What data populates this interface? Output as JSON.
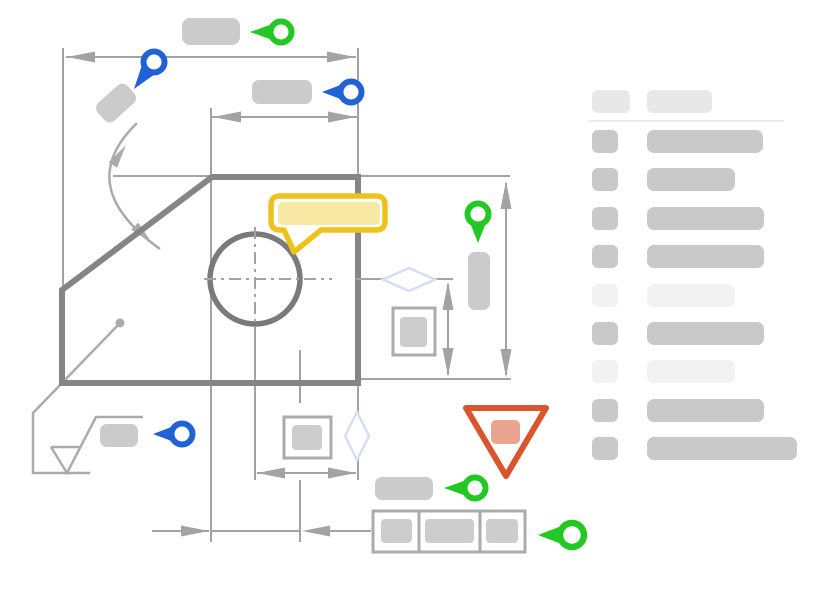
{
  "view": {
    "kind": "engineering-drawing-review-illustration",
    "has_text": false
  },
  "colors": {
    "pin_green": "#24C824",
    "pin_blue": "#2161D6",
    "comment_yellow": "#EFC21B",
    "comment_fill": "#F7E8A3",
    "warning_red": "#D8552E",
    "warning_fill": "#EAA48F",
    "outline_dark": "#858585",
    "circle_gray": "#7A7A7A",
    "line_gray": "#A3A3A3",
    "leader_gray": "#ABABAB",
    "placeholder_gray": "#CBCBCB",
    "chip_gray": "#CDCDCD",
    "header_gray": "#E8E8E8",
    "row_medium": "#C9C9C9",
    "row_light": "#F2F2F2",
    "divider_gray": "#EDEDED",
    "diamond_blue": "#D4DFF5"
  },
  "drawing": {
    "part": "chamfered-plate-with-hole",
    "annotations": [
      {
        "id": "pin-green-top",
        "icon": "pin-left-icon",
        "color": "green"
      },
      {
        "id": "pin-blue-angle",
        "icon": "pin-down-left-icon",
        "color": "blue"
      },
      {
        "id": "pin-blue-width",
        "icon": "pin-left-icon",
        "color": "blue"
      },
      {
        "id": "pin-green-height",
        "icon": "pin-down-icon",
        "color": "green"
      },
      {
        "id": "pin-blue-surface",
        "icon": "pin-left-icon",
        "color": "blue"
      },
      {
        "id": "pin-green-bottom",
        "icon": "pin-left-icon",
        "color": "green"
      },
      {
        "id": "pin-green-fcf",
        "icon": "pin-left-icon",
        "color": "green"
      },
      {
        "id": "comment-bubble",
        "icon": "speech-bubble-icon",
        "color": "yellow"
      },
      {
        "id": "warning-marker",
        "icon": "warning-triangle-icon",
        "color": "red"
      }
    ],
    "symbols": [
      {
        "id": "surface-finish-symbol"
      },
      {
        "id": "feature-control-frame",
        "cells": 3
      },
      {
        "id": "datum-diamond-right"
      },
      {
        "id": "datum-diamond-bottom"
      }
    ],
    "placeholder_labels": 7
  },
  "sidebar": {
    "header": [
      {
        "width": 38,
        "tone": "header"
      },
      {
        "width": 65,
        "tone": "header"
      }
    ],
    "rows": [
      {
        "tone": "medium",
        "width": 116
      },
      {
        "tone": "medium",
        "width": 88
      },
      {
        "tone": "medium",
        "width": 117
      },
      {
        "tone": "medium",
        "width": 117
      },
      {
        "tone": "light",
        "width": 88
      },
      {
        "tone": "medium",
        "width": 117
      },
      {
        "tone": "light",
        "width": 88
      },
      {
        "tone": "medium",
        "width": 117
      },
      {
        "tone": "medium",
        "width": 150
      }
    ]
  }
}
